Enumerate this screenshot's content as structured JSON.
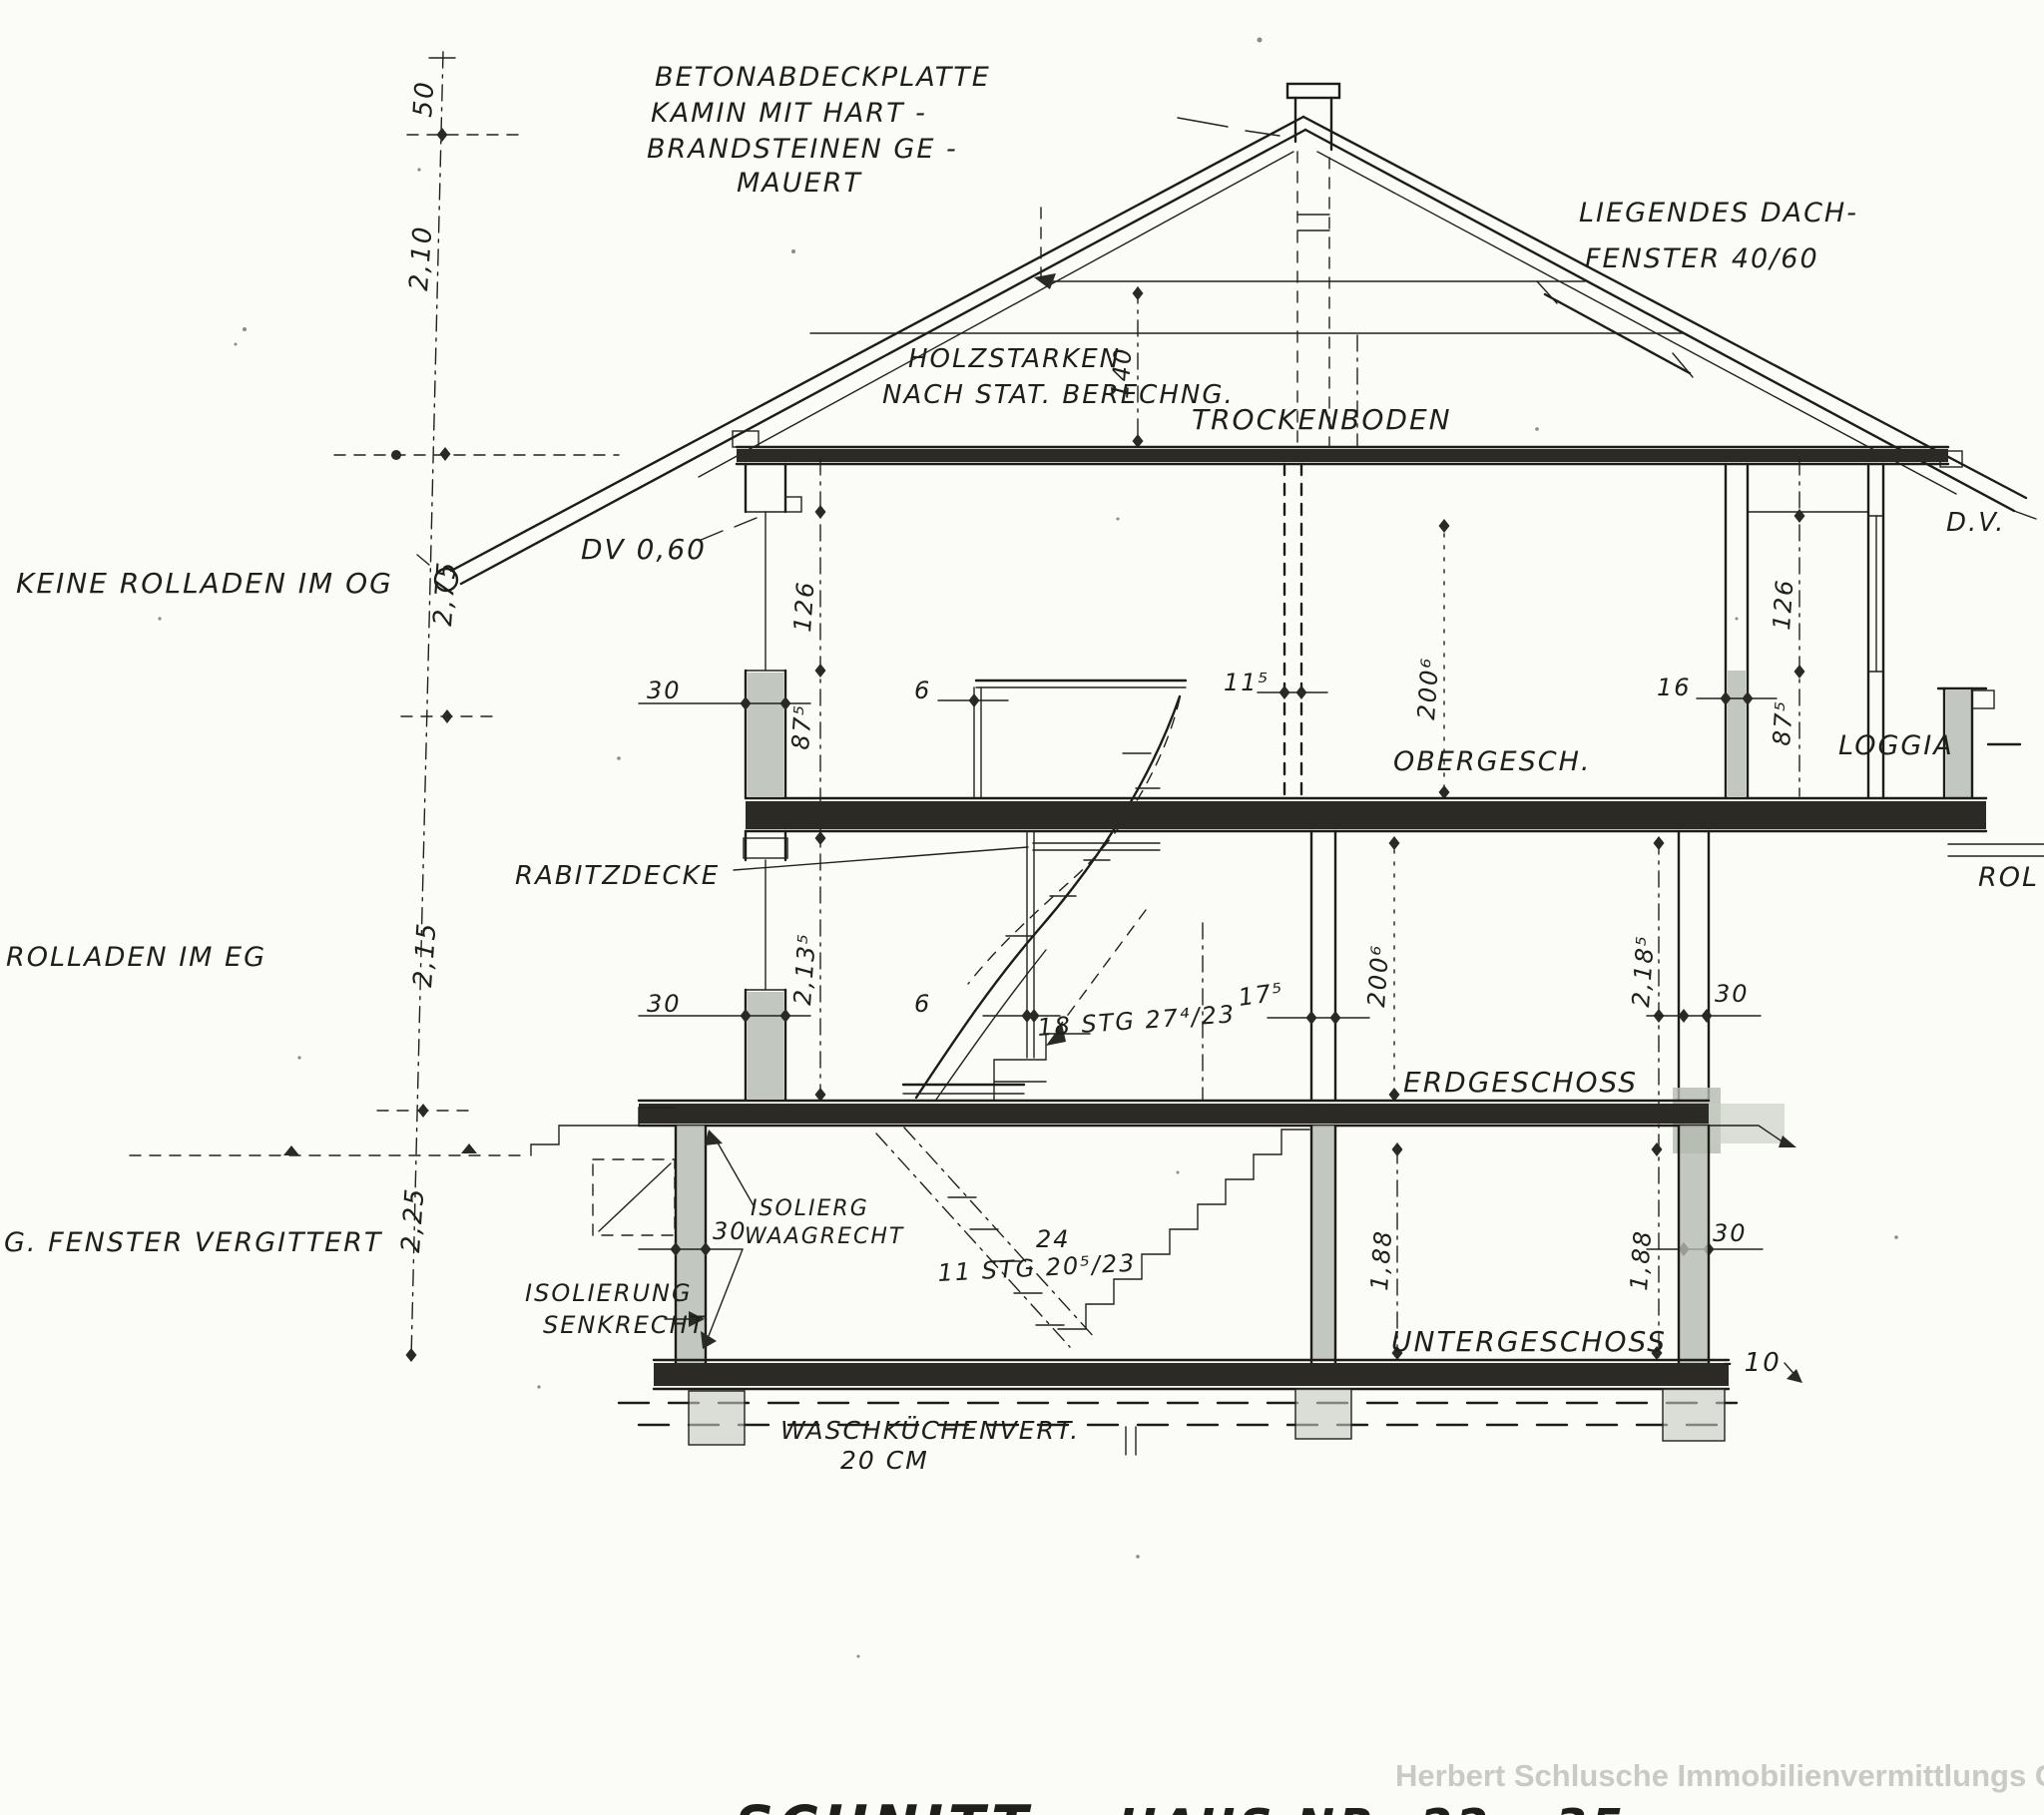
{
  "page": {
    "background": "#fbfbf8",
    "ink": "#1f1e1a",
    "shade": "#b4bab0",
    "watermark_color": "#c9c9c6"
  },
  "title": {
    "drawing_type": "SCHNITT",
    "house_no": "HAUS NR. 22 - 35",
    "watermark": "Herbert Schlusche Immobilienvermittlungs GmbH"
  },
  "notes": {
    "chimney_l1": "BETONABDECKPLATTE",
    "chimney_l2": "KAMIN MIT HART -",
    "chimney_l3": "BRANDSTEINEN GE -",
    "chimney_l4": "MAUERT",
    "roof_window_l1": "LIEGENDES DACH-",
    "roof_window_l2": "FENSTER 40/60",
    "timber_l1": "HOLZSTARKEN",
    "timber_l2": "NACH STAT. BERECHNG.",
    "no_shutters_og": "KEINE ROLLADEN IM OG",
    "shutters_eg": "ROLLADEN IM EG",
    "barred_windows": "G. FENSTER VERGITTERT",
    "dv_left": "DV 0,60",
    "dv_right": "D.V.",
    "rabitz_ceiling": "RABITZDECKE",
    "rol": "ROL",
    "insul_horiz_l1": "ISOLIERG",
    "insul_horiz_l2": "WAAGRECHT",
    "insul_vert_l1": "ISOLIERUNG",
    "insul_vert_l2": "SENKRECHT",
    "laundry_l1": "WASCHKÜCHENVERT.",
    "laundry_l2": "20 CM"
  },
  "levels": {
    "attic": "TROCKENBODEN",
    "og": "OBERGESCH.",
    "eg": "ERDGESCHOSS",
    "ug": "UNTERGESCHOSS",
    "loggia": "LOGGIA"
  },
  "stairs": {
    "eg_og": "18 STG 27⁴/23",
    "ug_eg": "11 STG 20⁵/23",
    "ug_count": "24"
  },
  "chain": [
    "50",
    "2,10",
    "2,75",
    "2,15",
    "2,25"
  ],
  "dims": {
    "collar_height": "140",
    "og_wall_left": "30",
    "og_window_h": "126",
    "og_parapet_h": "87⁵",
    "og_partition": "6",
    "og_inner_wall": "11⁵",
    "og_lintel_h": "200⁶",
    "og_wall_16": "16",
    "og_window_h_r": "126",
    "og_parapet_h_r": "87⁵",
    "eg_wall_left": "30",
    "eg_room_h": "2,13⁵",
    "eg_partition": "6",
    "eg_mid_wall": "17⁵",
    "eg_lintel_h": "200⁶",
    "eg_room_h_r": "2,18⁵",
    "eg_wall_right": "30",
    "ug_wall_left": "30",
    "ug_h_left": "1,88",
    "ug_h_right": "1,88",
    "ug_wall_right": "30",
    "ug_level": "- 10"
  }
}
